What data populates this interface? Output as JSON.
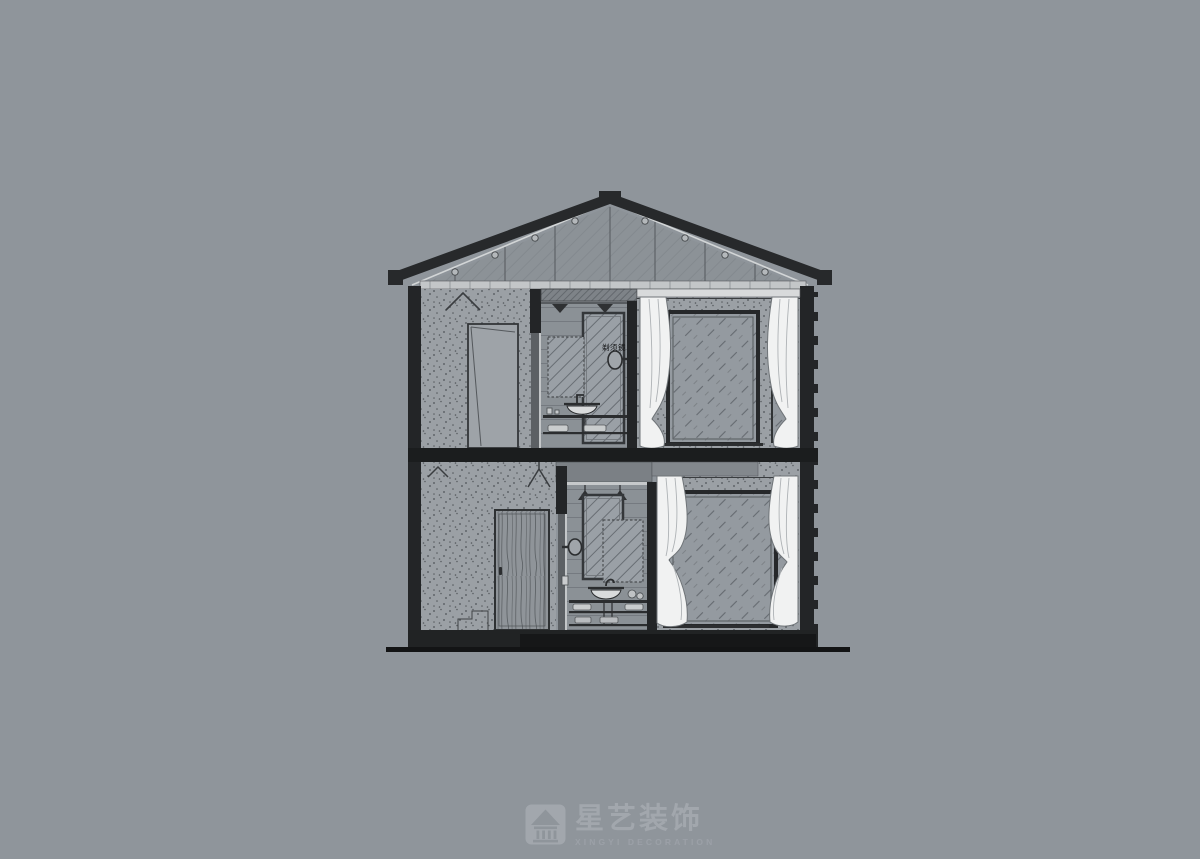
{
  "page": {
    "background_color": "#8f959b",
    "content": "two-storey residential cross-section drawing"
  },
  "drawing": {
    "annotations": {
      "shaving_mirror_label": "剃须镜"
    },
    "colors": {
      "cut_poche": "#232527",
      "wall_fill": "#9ba0a5",
      "glass_fill": "#959ba1",
      "curtain_fill": "#f1f2f2",
      "eaves_strip": "#c3c6c8"
    }
  },
  "watermark": {
    "brand_cn": "星艺装饰",
    "brand_en": "XINGYI DECORATION",
    "icon": "pavilion-logo-icon",
    "color": "#a4a9af"
  }
}
